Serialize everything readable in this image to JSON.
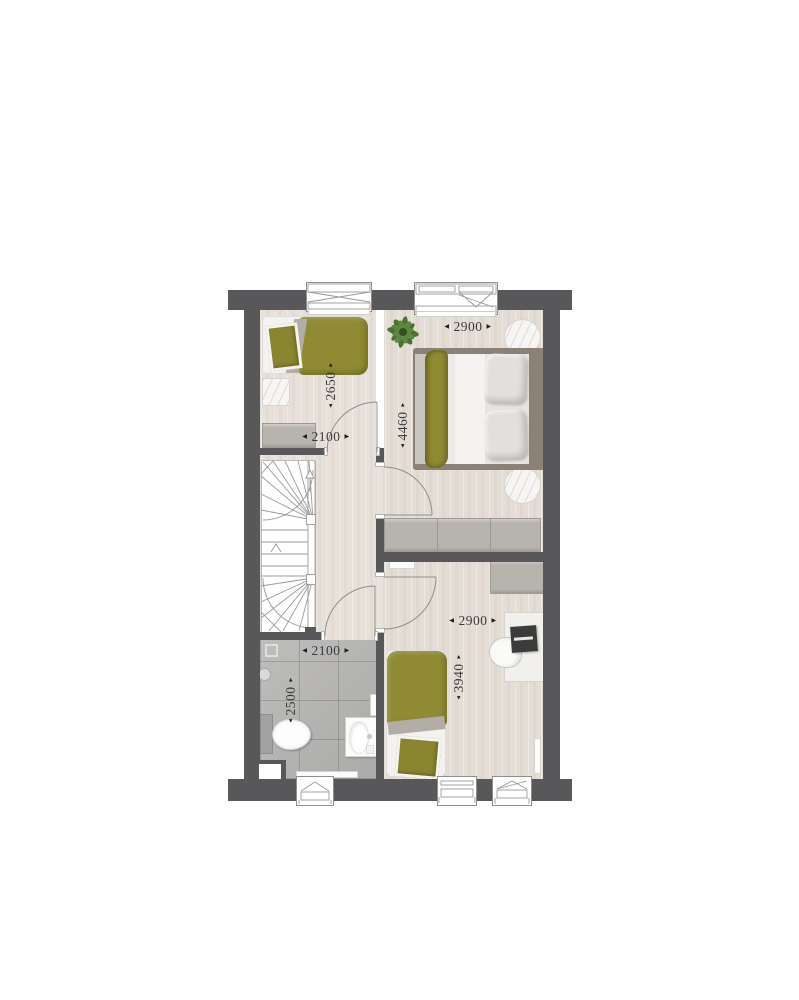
{
  "title": "floor-plan-upper-storey",
  "colors": {
    "wall": "#58585a",
    "wood": "#e8e1da",
    "tile": "#b5b4b2",
    "olive": "#8f8a33",
    "furniture_gray": "#b7b3ad",
    "bed_frame": "#8b8177",
    "plant_green": "#4d7133",
    "dimtext": "#3a3a3a"
  },
  "icons": {
    "arrow_left": "◀",
    "arrow_right": "▶",
    "arrow_up": "▲",
    "arrow_down": "▼"
  },
  "dimensions": [
    {
      "id": "bedroom1-width",
      "value": "2100",
      "orientation": "horizontal"
    },
    {
      "id": "bedroom1-depth",
      "value": "2650",
      "orientation": "vertical"
    },
    {
      "id": "master-width",
      "value": "2900",
      "orientation": "horizontal"
    },
    {
      "id": "master-depth",
      "value": "4460",
      "orientation": "vertical"
    },
    {
      "id": "bathroom-width",
      "value": "2100",
      "orientation": "horizontal"
    },
    {
      "id": "bathroom-depth",
      "value": "2500",
      "orientation": "vertical"
    },
    {
      "id": "bedroom2-width",
      "value": "2900",
      "orientation": "horizontal"
    },
    {
      "id": "bedroom2-depth",
      "value": "3940",
      "orientation": "vertical"
    }
  ]
}
